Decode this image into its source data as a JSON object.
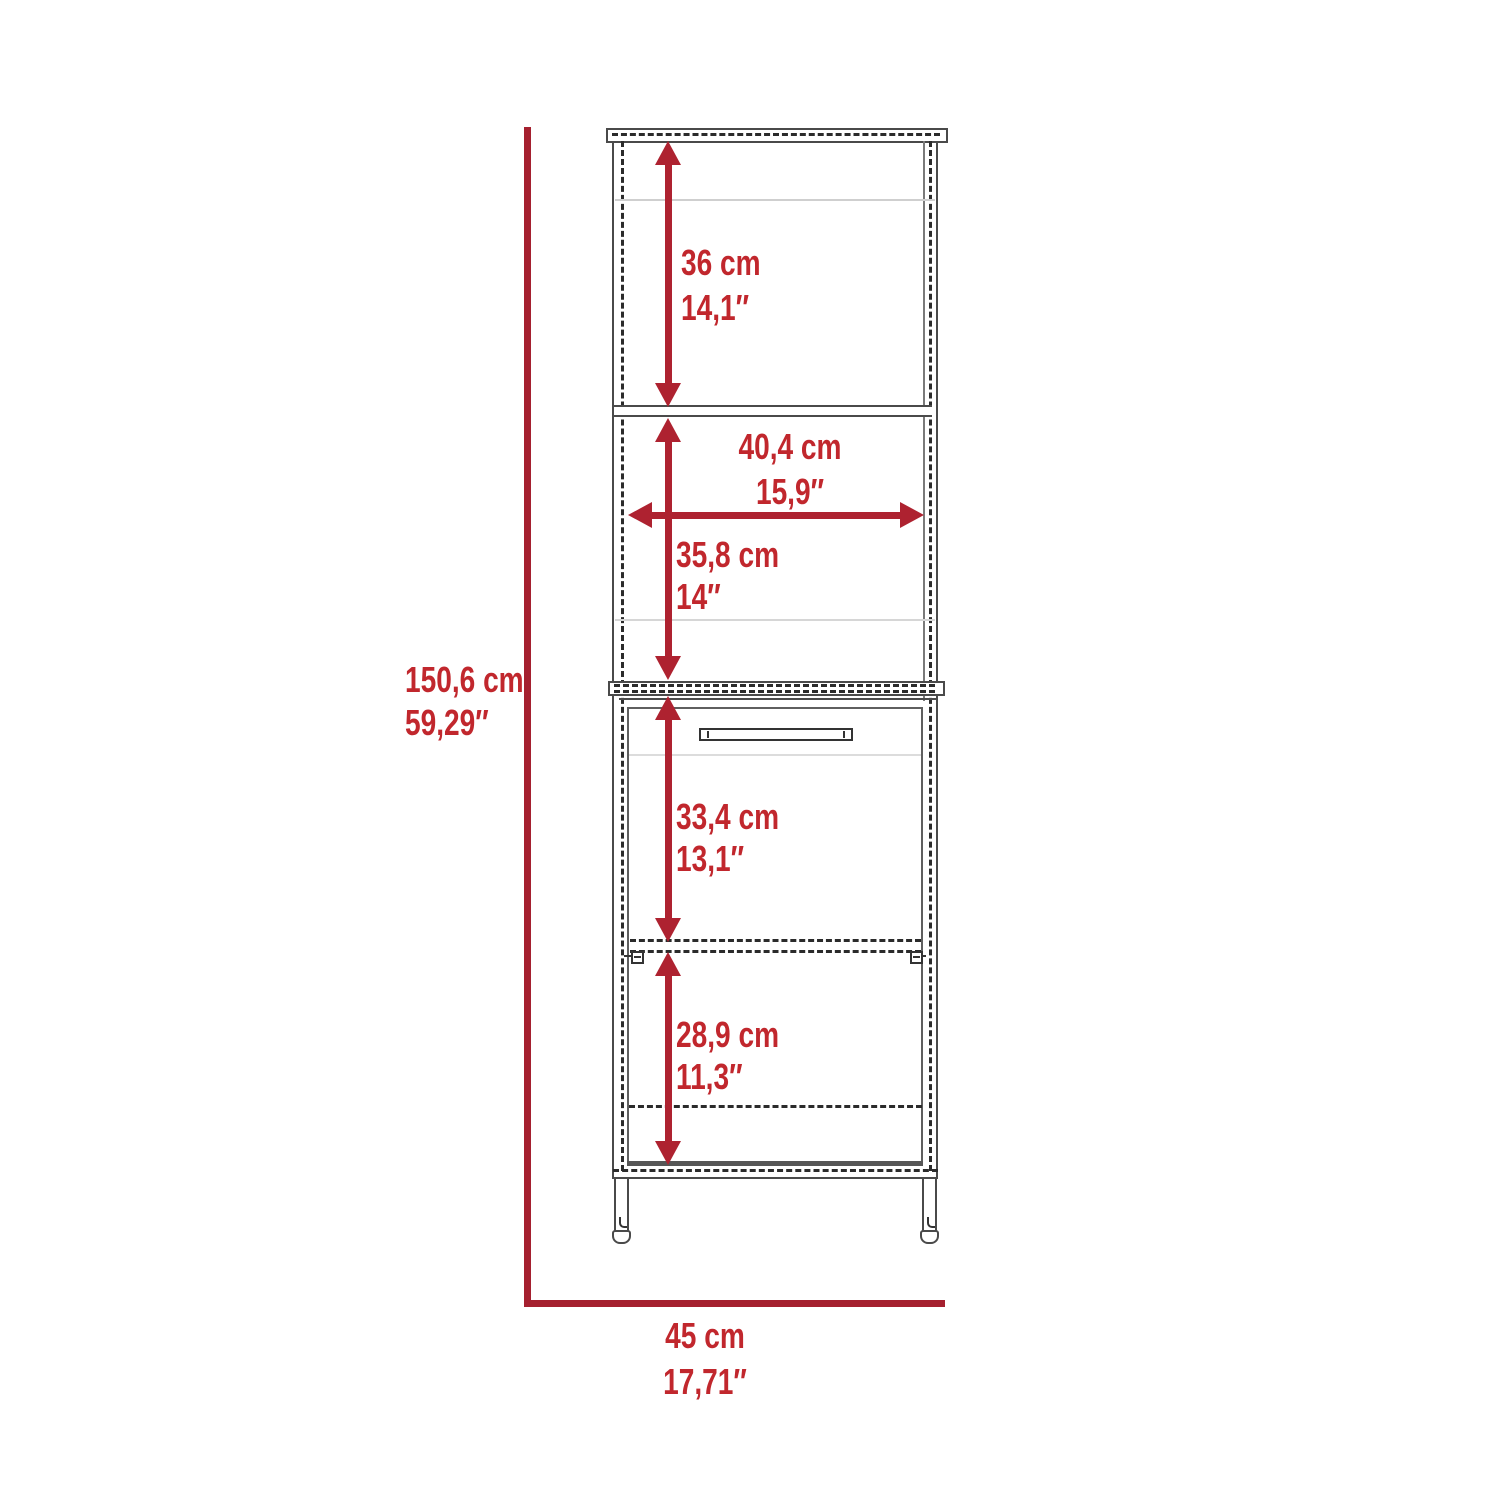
{
  "diagram_type": "furniture-dimension-diagram",
  "subject": "tall-linen-cabinet-front-view",
  "colors": {
    "dimension_line": "#a5202f",
    "arrow": "#ae2230",
    "label_text": "#c1272d",
    "outline": "#4a4a4a"
  },
  "overall": {
    "height": {
      "cm": "150,6 cm",
      "inch": "59,29″"
    },
    "width": {
      "cm": "45 cm",
      "inch": "17,71″"
    }
  },
  "sections": {
    "top_shelf_height": {
      "cm": "36 cm",
      "inch": "14,1″"
    },
    "interior_width": {
      "cm": "40,4 cm",
      "inch": "15,9″"
    },
    "middle_shelf_height": {
      "cm": "35,8 cm",
      "inch": "14″"
    },
    "cabinet_upper_height": {
      "cm": "33,4 cm",
      "inch": "13,1″"
    },
    "cabinet_lower_height": {
      "cm": "28,9 cm",
      "inch": "11,3″"
    }
  }
}
